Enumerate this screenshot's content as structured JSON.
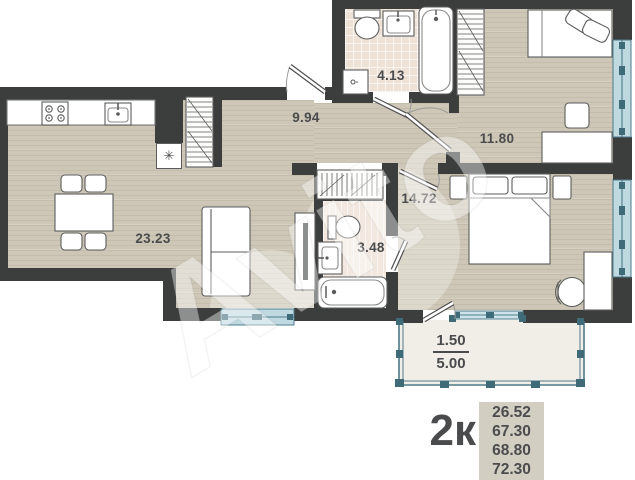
{
  "watermark": {
    "text": "Avito"
  },
  "plan": {
    "rooms": [
      {
        "key": "kitchen_living",
        "label": "23.23"
      },
      {
        "key": "hallway",
        "label": "9.94"
      },
      {
        "key": "bathroom_main",
        "label": "4.13"
      },
      {
        "key": "bedroom_small",
        "label": "11.80"
      },
      {
        "key": "bedroom_master",
        "label": "14.72"
      },
      {
        "key": "bathroom_small",
        "label": "3.48"
      }
    ],
    "balcony": {
      "reduced_area": "1.50",
      "full_area": "5.00"
    },
    "icons": {
      "fridge": "✳"
    }
  },
  "legend": {
    "flat_type": "2к",
    "areas": [
      "26.52",
      "67.30",
      "68.80",
      "72.30"
    ]
  },
  "colors": {
    "wall": "#3c3d3d",
    "floor_wood": "#cec7b7",
    "floor_tile": "#eee1d5",
    "window_fill": "#bed9e0",
    "window_frame": "#4e7b8b",
    "text": "#4a4b4c",
    "legend_box": "#d3cec2"
  }
}
